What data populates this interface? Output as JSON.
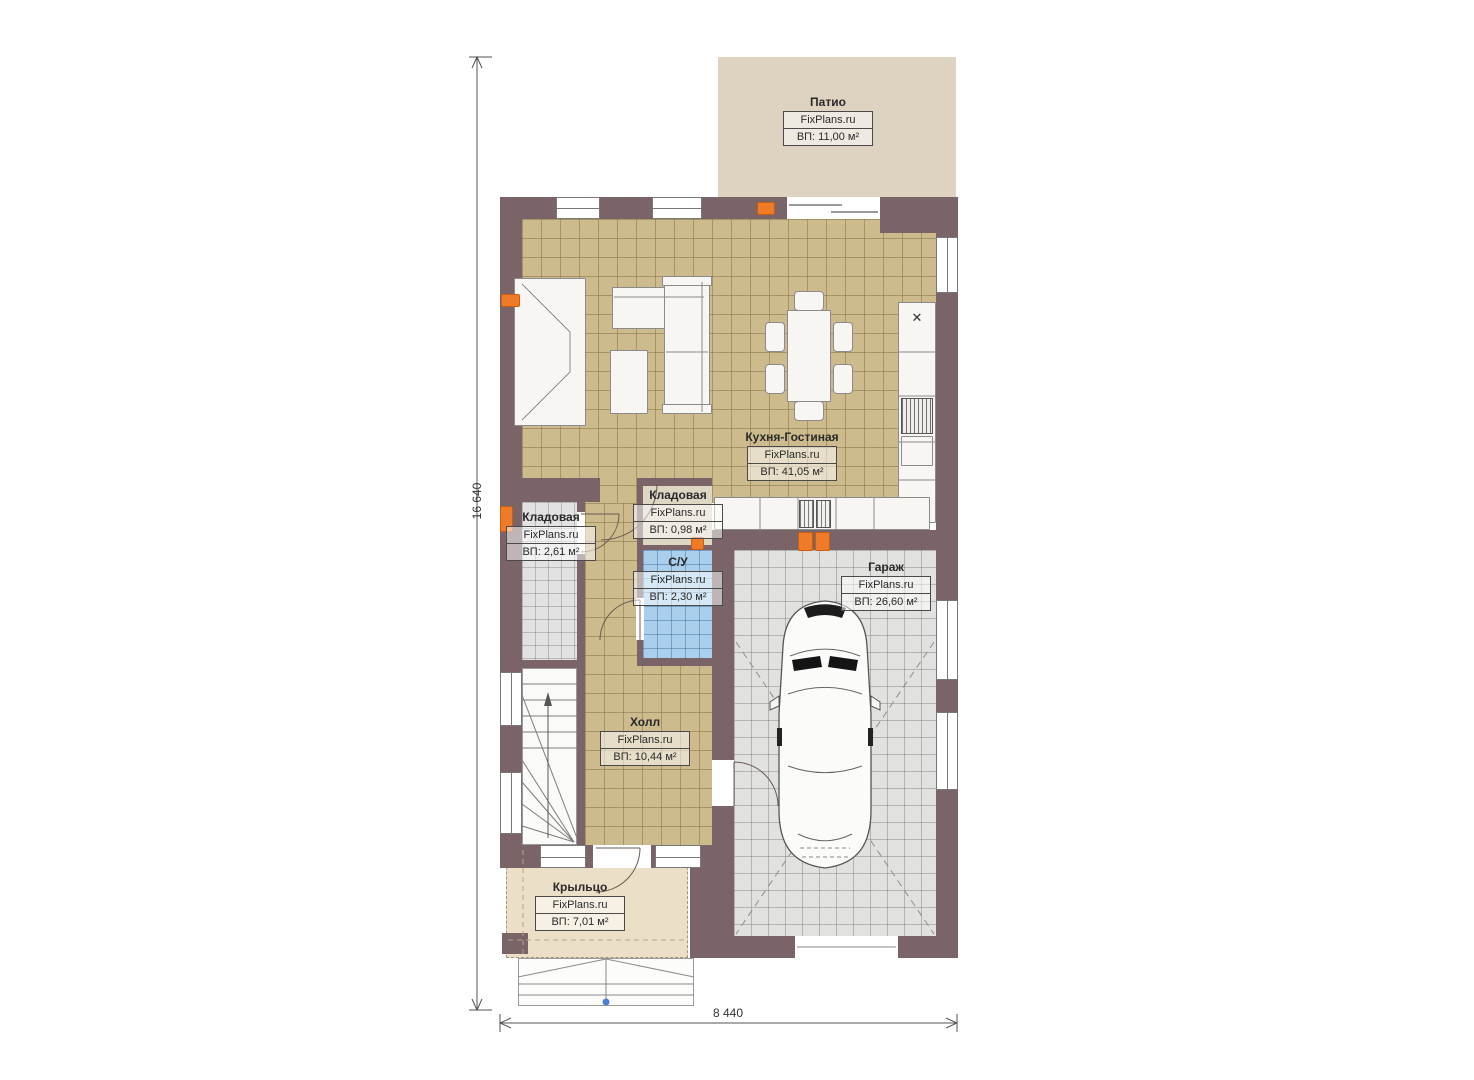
{
  "site": "FixPlans.ru",
  "dimensions": {
    "height_mm": "16 640",
    "width_mm": "8 440"
  },
  "rooms": [
    {
      "name": "Патио",
      "site": "FixPlans.ru",
      "area": "ВП: 11,00 м²"
    },
    {
      "name": "Кухня-Гостиная",
      "site": "FixPlans.ru",
      "area": "ВП: 41,05 м²"
    },
    {
      "name": "Кладовая",
      "site": "FixPlans.ru",
      "area": "ВП: 2,61 м²"
    },
    {
      "name": "Кладовая",
      "site": "FixPlans.ru",
      "area": "ВП: 0,98 м²"
    },
    {
      "name": "С/У",
      "site": "FixPlans.ru",
      "area": "ВП: 2,30 м²"
    },
    {
      "name": "Холл",
      "site": "FixPlans.ru",
      "area": "ВП: 10,44 м²"
    },
    {
      "name": "Гараж",
      "site": "FixPlans.ru",
      "area": "ВП: 26,60 м²"
    },
    {
      "name": "Крыльцо",
      "site": "FixPlans.ru",
      "area": "ВП: 7,01 м²"
    }
  ],
  "icons": {
    "sink": "✕"
  },
  "colors": {
    "wall": "#7a6468",
    "floor_living": "#cdbb8e",
    "floor_storage": "#e2e2e2",
    "floor_bath": "#a9cfec",
    "floor_garage": "#e1e1df",
    "patio": "#ddd3c0",
    "porch": "#ecdfc8",
    "radiator": "#ef7b28",
    "dimension": "#555555"
  }
}
